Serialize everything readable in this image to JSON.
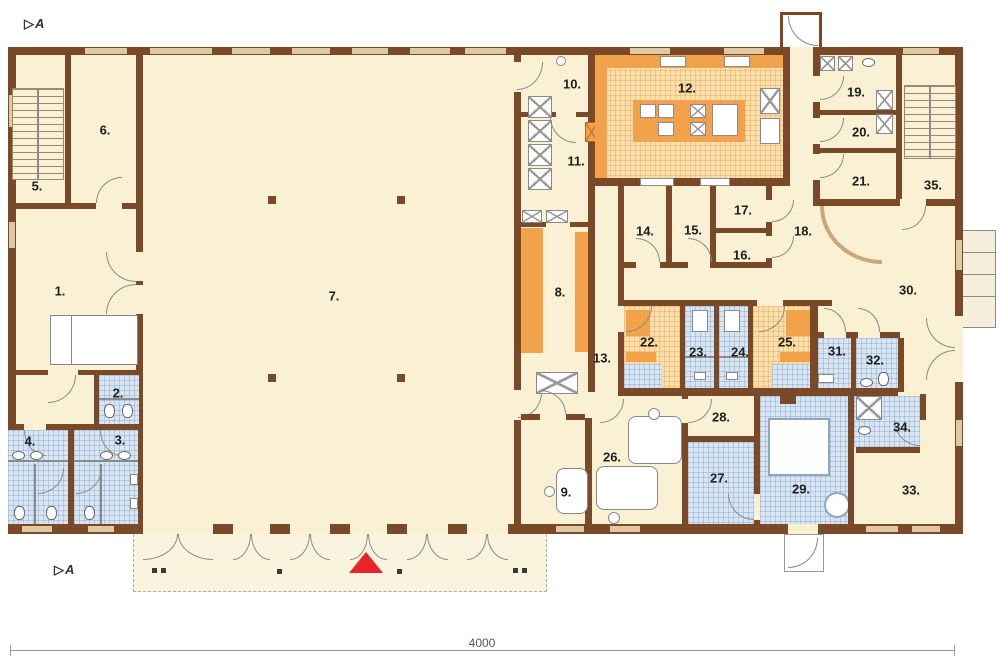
{
  "plan": {
    "rooms": [
      {
        "label": "1."
      },
      {
        "label": "2."
      },
      {
        "label": "3."
      },
      {
        "label": "4."
      },
      {
        "label": "5."
      },
      {
        "label": "6."
      },
      {
        "label": "7."
      },
      {
        "label": "8."
      },
      {
        "label": "9."
      },
      {
        "label": "10."
      },
      {
        "label": "11."
      },
      {
        "label": "12."
      },
      {
        "label": "13."
      },
      {
        "label": "14."
      },
      {
        "label": "15."
      },
      {
        "label": "16."
      },
      {
        "label": "17."
      },
      {
        "label": "18."
      },
      {
        "label": "19."
      },
      {
        "label": "20."
      },
      {
        "label": "21."
      },
      {
        "label": "22."
      },
      {
        "label": "23."
      },
      {
        "label": "24."
      },
      {
        "label": "25."
      },
      {
        "label": "26."
      },
      {
        "label": "27."
      },
      {
        "label": "28."
      },
      {
        "label": "29."
      },
      {
        "label": "30."
      },
      {
        "label": "31."
      },
      {
        "label": "32."
      },
      {
        "label": "33."
      },
      {
        "label": "34."
      },
      {
        "label": "35."
      }
    ],
    "section_markers": {
      "top": "A",
      "bottom": "A",
      "glyph": "▷"
    },
    "dimension": {
      "label": "4000"
    },
    "icons": {
      "entrance_marker": "red-triangle",
      "stairs": "striped-treads",
      "door_swing": "quarter-arc",
      "equipment": "crossed-box"
    },
    "colors": {
      "wall": "#7a4928",
      "floor": "#faf0d3",
      "window": "#dfc9a2",
      "terrace": "#faf4df",
      "wet_tile": "#d8e6f4",
      "kitchen_tile": "#f9dfae",
      "accent_orange": "#f2a24b",
      "entrance_marker": "#e8232a"
    }
  }
}
